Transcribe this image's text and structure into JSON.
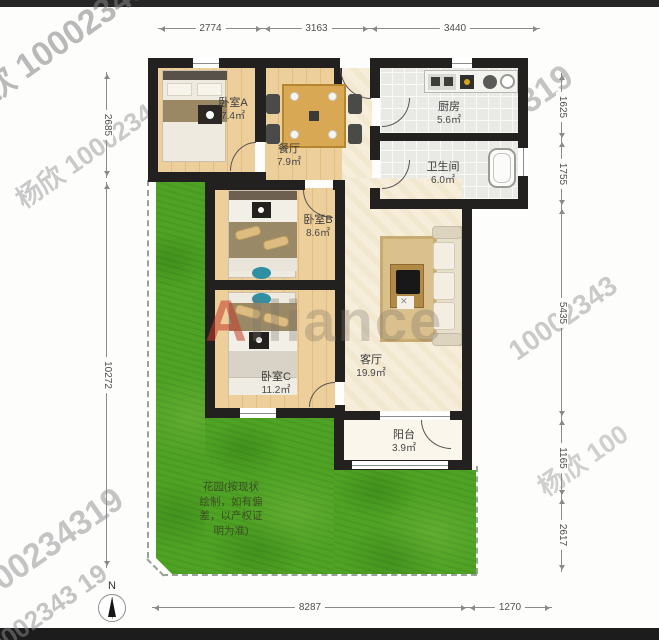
{
  "rooms": [
    {
      "name": "卧室A",
      "area": "7.4㎡"
    },
    {
      "name": "餐厅",
      "area": "7.9㎡"
    },
    {
      "name": "厨房",
      "area": "5.6㎡"
    },
    {
      "name": "卫生间",
      "area": "6.0㎡"
    },
    {
      "name": "卧室B",
      "area": "8.6㎡"
    },
    {
      "name": "卧室C",
      "area": "11.2㎡"
    },
    {
      "name": "客厅",
      "area": "19.9㎡"
    },
    {
      "name": "阳台",
      "area": "3.9㎡"
    }
  ],
  "garden_note_lines": [
    "花园(按现状",
    "绘制，如有偏",
    "差，以产权证",
    "明为准)"
  ],
  "dimensions": {
    "top": [
      "2774",
      "3163",
      "3440"
    ],
    "left": [
      "2685",
      "10272"
    ],
    "right": [
      "1625",
      "1755",
      "5435",
      "1165",
      "2617"
    ],
    "bottom": [
      "8287",
      "1270"
    ]
  },
  "compass": {
    "label": "N"
  },
  "watermarks": {
    "brand": "Alliance",
    "diagonal": [
      "欣 1000234319",
      "杨欣 10002343",
      "1000234319",
      "10002343 19",
      "0234319",
      "34319",
      "10002343",
      "杨欣 100",
      "杨欣"
    ]
  },
  "colors": {
    "wall": "#222120",
    "wood_floor": "#e8c78f",
    "living_floor": "#f6eeda",
    "tile_floor": "#e9e9e5",
    "garden_green": "#4fa324",
    "dimension_line": "#8a8a8a",
    "brand_red": "#c43c2a",
    "top_bottom_bar": "#262626"
  }
}
